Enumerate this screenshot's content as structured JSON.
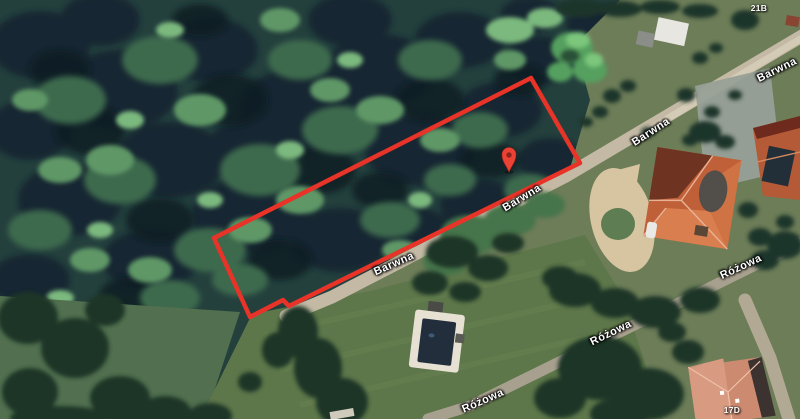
{
  "map": {
    "view": "satellite",
    "street_labels": [
      {
        "name": "Barwna"
      },
      {
        "name": "Barwna"
      },
      {
        "name": "Barwna"
      },
      {
        "name": "Barwna"
      },
      {
        "name": "Różowa"
      },
      {
        "name": "Różowa"
      },
      {
        "name": "Różowa"
      }
    ],
    "address_labels": [
      {
        "text": "21B"
      },
      {
        "text": "17D"
      }
    ],
    "plot": {
      "outline_color": "#e73328",
      "vertices_points": "214,238 531,78 580,163 289,306 283,300 250,317"
    },
    "pin": {
      "color": "#ea4335",
      "inner_color": "#8c241b"
    },
    "label_text_color": "#ffffff"
  }
}
